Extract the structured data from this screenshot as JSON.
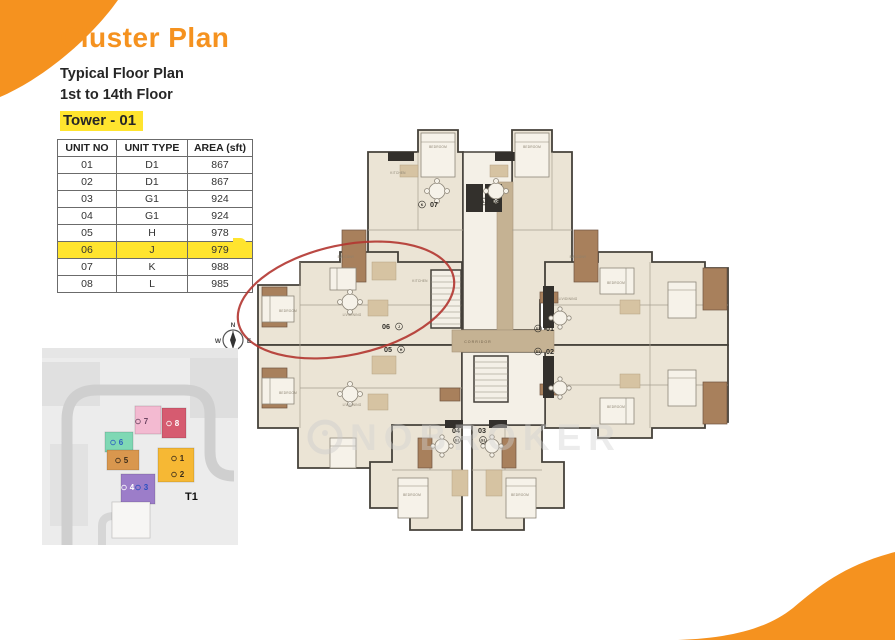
{
  "header": {
    "title": "Cluster Plan",
    "subtitle_line1": "Typical Floor Plan",
    "subtitle_line2": "1st to 14th Floor",
    "tower_label": "Tower - 01"
  },
  "unit_table": {
    "headers": [
      "UNIT NO",
      "UNIT TYPE",
      "AREA (sft)"
    ],
    "rows": [
      [
        "01",
        "D1",
        "867"
      ],
      [
        "02",
        "D1",
        "867"
      ],
      [
        "03",
        "G1",
        "924"
      ],
      [
        "04",
        "G1",
        "924"
      ],
      [
        "05",
        "H",
        "978"
      ],
      [
        "06",
        "J",
        "979"
      ],
      [
        "07",
        "K",
        "988"
      ],
      [
        "08",
        "L",
        "985"
      ]
    ],
    "highlighted_row": "06"
  },
  "compass": {
    "n": "N",
    "e": "E",
    "s": "S",
    "w": "W"
  },
  "floor_plan": {
    "corridor_label": "CORRIDOR",
    "unit_labels": [
      {
        "no": "07",
        "type": "K",
        "x": 434,
        "y": 207,
        "tp": "before"
      },
      {
        "no": "08",
        "type": "L",
        "x": 496,
        "y": 204,
        "tp": "before"
      },
      {
        "no": "06",
        "type": "J",
        "x": 386,
        "y": 329,
        "tp": "after"
      },
      {
        "no": "05",
        "type": "H",
        "x": 388,
        "y": 352,
        "tp": "after"
      },
      {
        "no": "01",
        "type": "D1",
        "x": 550,
        "y": 331,
        "tp": "before"
      },
      {
        "no": "02",
        "type": "D1",
        "x": 550,
        "y": 354,
        "tp": "before"
      },
      {
        "no": "04",
        "type": "G1",
        "x": 456,
        "y": 433,
        "tp": "below"
      },
      {
        "no": "03",
        "type": "G1",
        "x": 482,
        "y": 433,
        "tp": "below"
      }
    ],
    "room_labels": [
      {
        "t": "BEDROOM",
        "x": 288,
        "y": 312
      },
      {
        "t": "LIV/DINING",
        "x": 352,
        "y": 316
      },
      {
        "t": "KITCHEN",
        "x": 420,
        "y": 282
      },
      {
        "t": "BEDROOM",
        "x": 288,
        "y": 394
      },
      {
        "t": "LIV/DINING",
        "x": 352,
        "y": 406
      },
      {
        "t": "BEDROOM",
        "x": 438,
        "y": 148
      },
      {
        "t": "BEDROOM",
        "x": 532,
        "y": 148
      },
      {
        "t": "KITCHEN",
        "x": 398,
        "y": 174
      },
      {
        "t": "BEDROOM",
        "x": 616,
        "y": 284
      },
      {
        "t": "LIV/DINING",
        "x": 568,
        "y": 300
      },
      {
        "t": "BEDROOM",
        "x": 616,
        "y": 408
      },
      {
        "t": "BEDROOM",
        "x": 412,
        "y": 496
      },
      {
        "t": "BEDROOM",
        "x": 520,
        "y": 496
      },
      {
        "t": "BALCONY",
        "x": 346,
        "y": 258
      },
      {
        "t": "BALCONY",
        "x": 578,
        "y": 258
      }
    ]
  },
  "watermark": {
    "text": "NOBROKER"
  },
  "site_map": {
    "tower_label": "T1",
    "blocks": [
      {
        "color": "#f3bad1",
        "x": 93,
        "y": 58,
        "w": 26,
        "h": 28
      },
      {
        "color": "#d65b70",
        "x": 120,
        "y": 60,
        "w": 24,
        "h": 30
      },
      {
        "color": "#7fd8b4",
        "x": 63,
        "y": 84,
        "w": 28,
        "h": 20
      },
      {
        "color": "#d9974e",
        "x": 65,
        "y": 102,
        "w": 32,
        "h": 20
      },
      {
        "color": "#f6b834",
        "x": 116,
        "y": 100,
        "w": 36,
        "h": 34
      },
      {
        "color": "#9c7dc9",
        "x": 79,
        "y": 126,
        "w": 34,
        "h": 30
      },
      {
        "color": "#f7f6f4",
        "x": 70,
        "y": 154,
        "w": 38,
        "h": 36
      }
    ],
    "unit_labels": [
      {
        "no": "7",
        "x": 102,
        "y": 76,
        "color": "#6e4663"
      },
      {
        "no": "8",
        "x": 133,
        "y": 78,
        "color": "#ffffff"
      },
      {
        "no": "6",
        "x": 77,
        "y": 97,
        "color": "#2b5fc0"
      },
      {
        "no": "5",
        "x": 82,
        "y": 115,
        "color": "#3a2c1a"
      },
      {
        "no": "1",
        "x": 138,
        "y": 113,
        "color": "#3a2c1a"
      },
      {
        "no": "2",
        "x": 138,
        "y": 129,
        "color": "#3a2c1a"
      },
      {
        "no": "4",
        "x": 88,
        "y": 142,
        "color": "#ffffff"
      },
      {
        "no": "3",
        "x": 102,
        "y": 142,
        "color": "#2b4fc0"
      }
    ]
  },
  "colors": {
    "accent_orange": "#F5921F",
    "highlight_yellow": "#FFE42E",
    "red_circle": "#B23530",
    "plan_beige": "#EBE4D5",
    "balcony_brown": "#A8805C",
    "corridor_tan": "#C5B293"
  }
}
